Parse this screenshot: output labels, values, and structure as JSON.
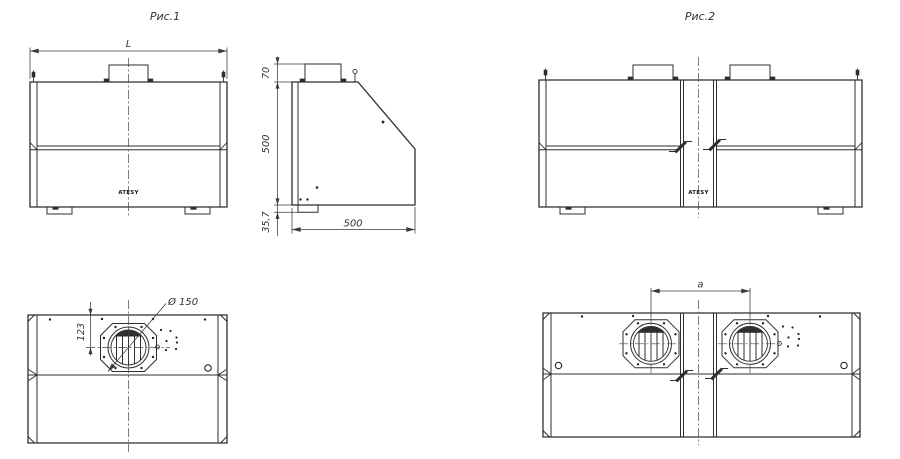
{
  "page": {
    "background": "#ffffff",
    "line_color": "#2e2e2e",
    "dim_color": "#3a3a3a"
  },
  "fig1": {
    "title": "Рис.1",
    "brand": "ATESY",
    "dims": {
      "overall_width": "L",
      "duct_height": "70",
      "body_height": "500",
      "foot_height": "35,7",
      "body_depth": "500",
      "flue_diameter": "Ø 150",
      "flue_offset": "123"
    }
  },
  "fig2": {
    "title": "Рис.2",
    "brand": "ATESY",
    "dims": {
      "flue_spacing": "a"
    }
  }
}
